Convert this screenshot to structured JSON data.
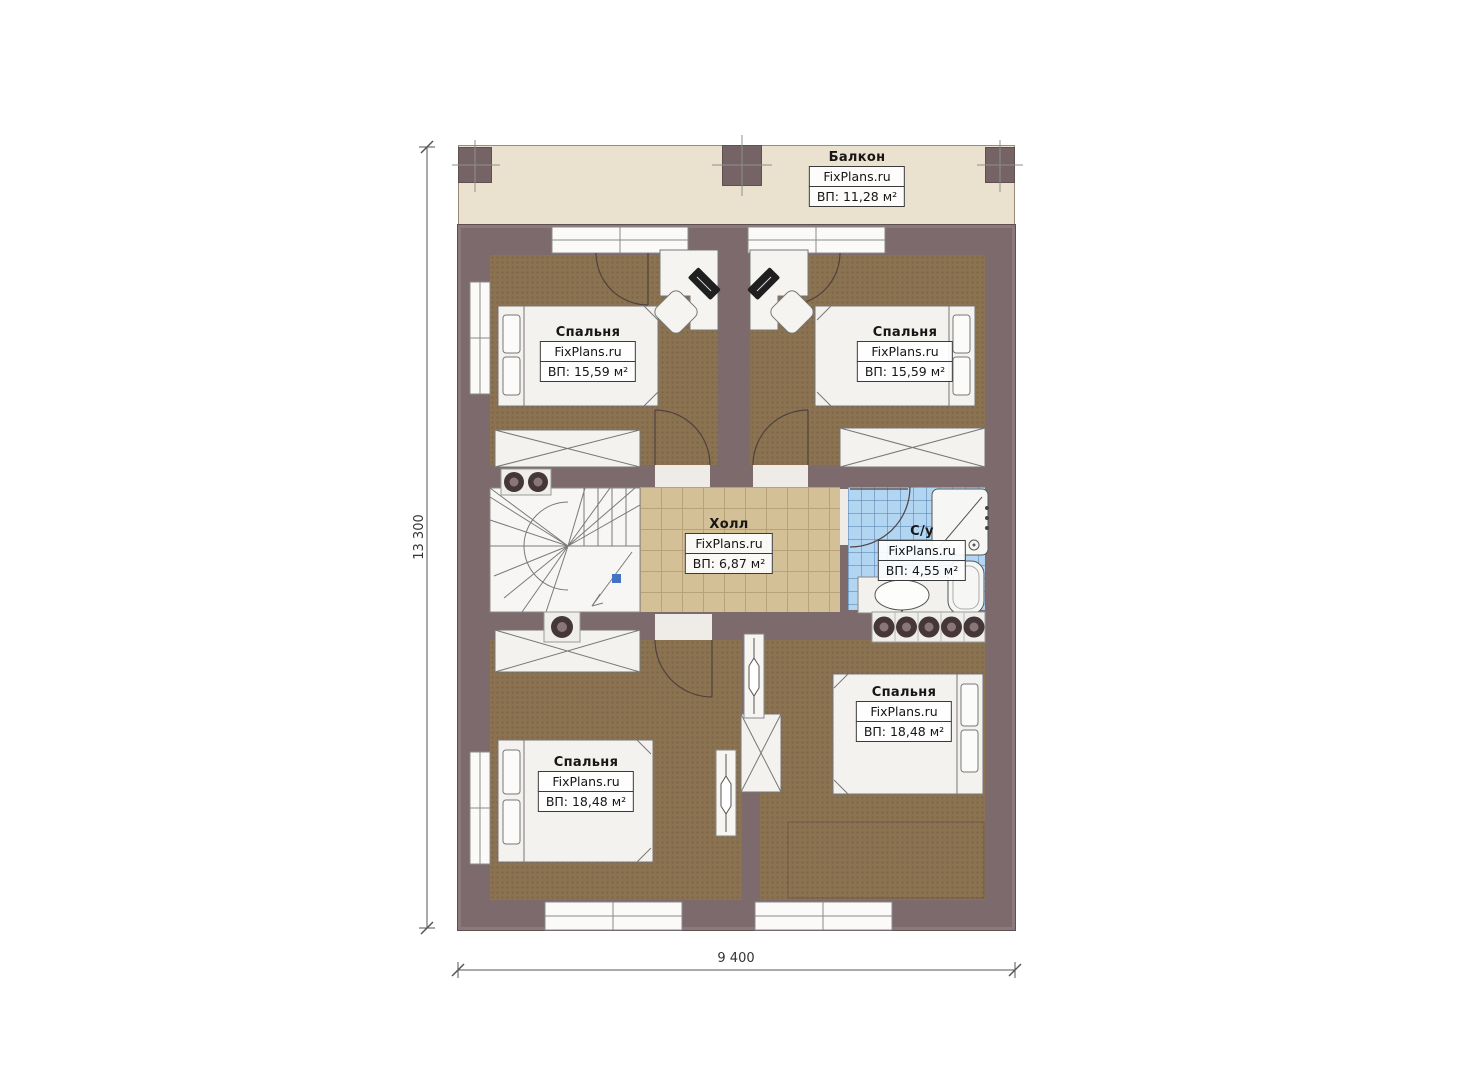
{
  "brand": "FixPlans.ru",
  "dimensions": {
    "height_label": "13 300",
    "width_label": "9 400"
  },
  "rooms": {
    "balcony": {
      "title": "Балкон",
      "brand": "FixPlans.ru",
      "area": "ВП: 11,28 м²"
    },
    "bedroom_top_left": {
      "title": "Спальня",
      "brand": "FixPlans.ru",
      "area": "ВП: 15,59 м²"
    },
    "bedroom_top_right": {
      "title": "Спальня",
      "brand": "FixPlans.ru",
      "area": "ВП: 15,59 м²"
    },
    "hall": {
      "title": "Холл",
      "brand": "FixPlans.ru",
      "area": "ВП: 6,87 м²"
    },
    "bathroom": {
      "title": "С/у",
      "brand": "FixPlans.ru",
      "area": "ВП: 4,55 м²"
    },
    "bedroom_bottom_left": {
      "title": "Спальня",
      "brand": "FixPlans.ru",
      "area": "ВП: 18,48 м²"
    },
    "bedroom_bottom_right": {
      "title": "Спальня",
      "brand": "FixPlans.ru",
      "area": "ВП: 18,48 м²"
    }
  },
  "colors": {
    "wall": "#7c6a6c",
    "carpet": "#8b7352",
    "hall_tile": "#d4c096",
    "bath_tile": "#b2d5f2",
    "balcony_floor": "#eae1ce",
    "stair_marker_blue": "#4472c4"
  }
}
